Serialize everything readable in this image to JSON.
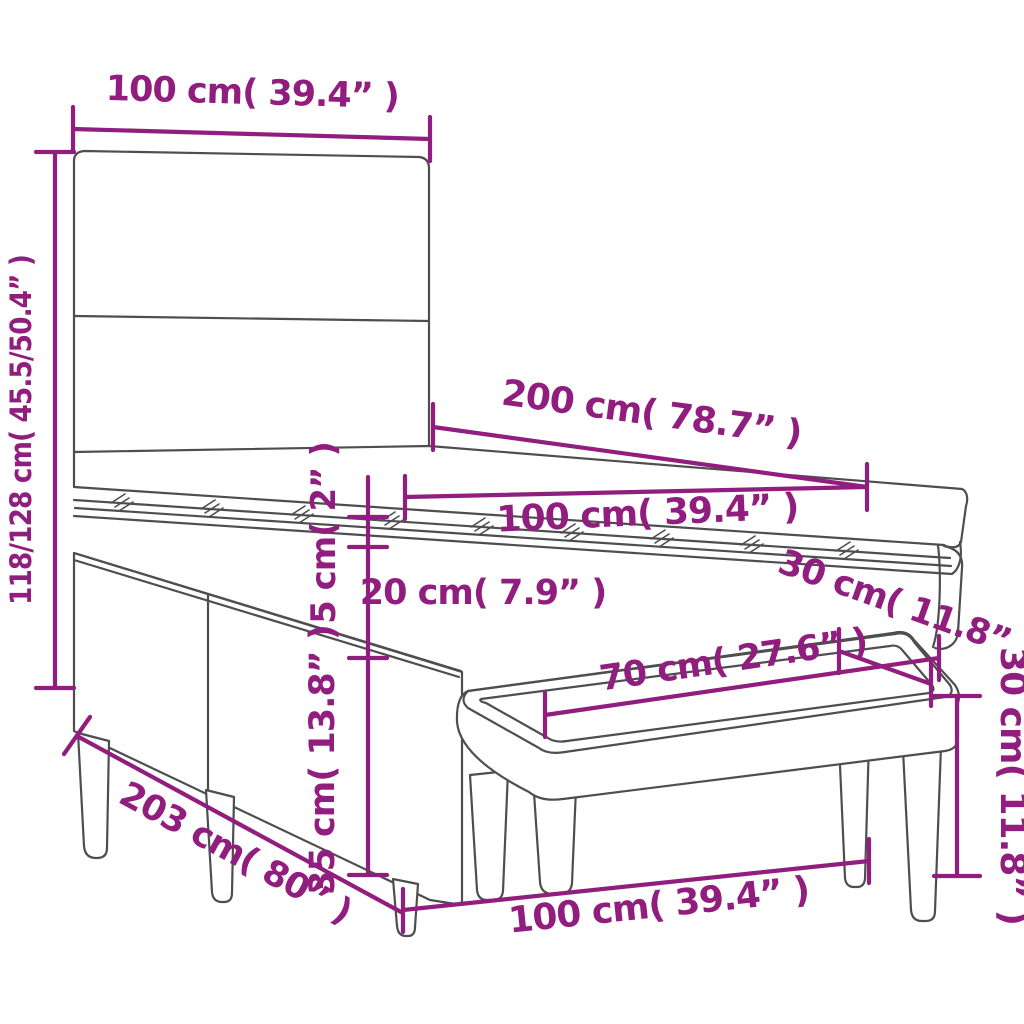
{
  "diagram": {
    "kind": "product-dimension-diagram",
    "subject": "box spring bed with headboard, mattress topper and bench",
    "accent_color": "#911e7e",
    "line_color": "#4e4e50",
    "background_color": "#ffffff",
    "labels": {
      "headboard_width": "100 cm( 39.4” )",
      "overall_height": "118/128 cm( 45.5/50.4” )",
      "mattress_length": "200 cm( 78.7” )",
      "mattress_width": "100 cm( 39.4” )",
      "topper_thickness": "5 cm( 2” )",
      "mattress_thickness": "20 cm( 7.9” )",
      "base_height": "35 cm( 13.8” )",
      "base_length": "203 cm( 80” )",
      "bench_seat_length": "70 cm( 27.6” )",
      "bench_depth": "30 cm( 11.8” )",
      "bench_height": "30 cm( 11.8” )",
      "bench_length": "100 cm( 39.4” )"
    }
  }
}
